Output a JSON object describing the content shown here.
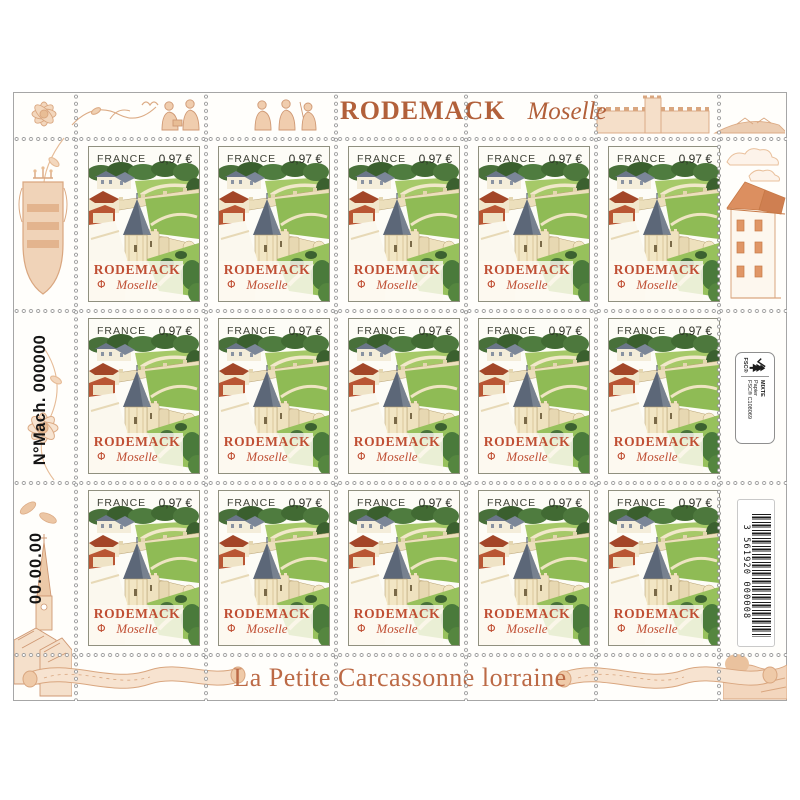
{
  "sheet_header": {
    "title": "RODEMACK",
    "region": "Moselle"
  },
  "sheet_footer": {
    "caption": "La Petite Carcassonne lorraine"
  },
  "left_margin": {
    "machine_text": "N°Mach. 000000",
    "date_text": "00.00.00"
  },
  "right_margin": {
    "fsc_label": {
      "brand": "FSC®",
      "line1": "MIXTE",
      "line2": "Papier",
      "line3": "FSC® C108069"
    },
    "barcode": {
      "number": "3 561920 000008"
    }
  },
  "stamp": {
    "country": "FRANCE",
    "value": "0,97 €",
    "name": "RODEMACK",
    "region": "Moselle",
    "printer_mark": "Φ"
  },
  "grid": {
    "rows": 3,
    "cols": 5,
    "count": 15
  },
  "colors": {
    "accent_terracotta": "#b2603a",
    "stamp_text_red": "#c04f34",
    "decor_peach": "#e9c09c",
    "tower_roof_slate": "#5c6778",
    "lawn_green": "#8fbb55",
    "tree_green": "#4a7a3b"
  }
}
